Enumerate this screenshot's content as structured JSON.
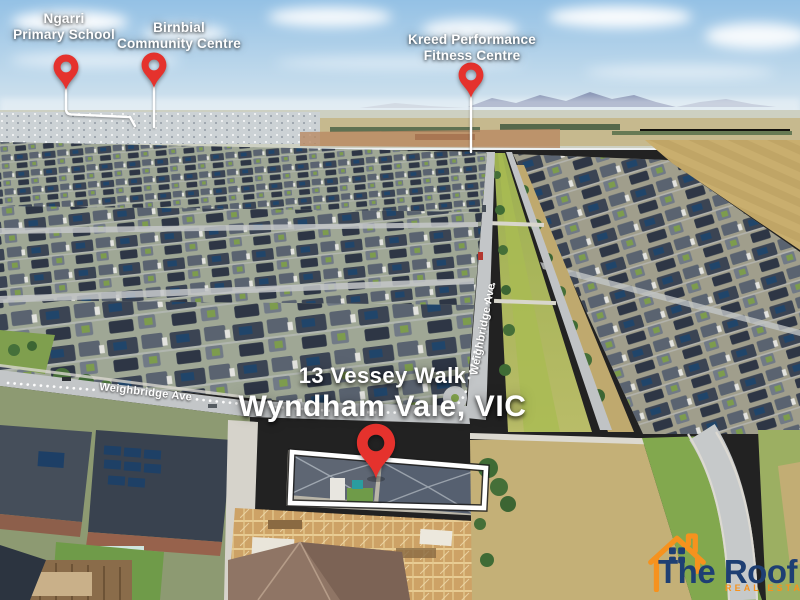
{
  "pins": {
    "ngarri": {
      "line1": "Ngarri",
      "line2": "Primary School"
    },
    "birnbial": {
      "line1": "Birnbial",
      "line2": "Community Centre"
    },
    "kreed": {
      "line1": "Kreed Performance",
      "line2": "Fitness Centre"
    }
  },
  "property": {
    "address_line1": "13 Vessey Walk",
    "address_line2": "Wyndham Vale, VIC"
  },
  "streets": {
    "weighbridge_horizontal": "Weighbridge Ave",
    "weighbridge_vertical": "Weighbridge Ave"
  },
  "logo": {
    "title": "The Roof",
    "tagline": "REAL ESTATE"
  },
  "colors": {
    "pin_red": "#e5322d",
    "label_white": "#ffffff",
    "outline_white": "#ffffff",
    "logo_navy": "#1e3f73",
    "logo_orange": "#f6921e"
  }
}
